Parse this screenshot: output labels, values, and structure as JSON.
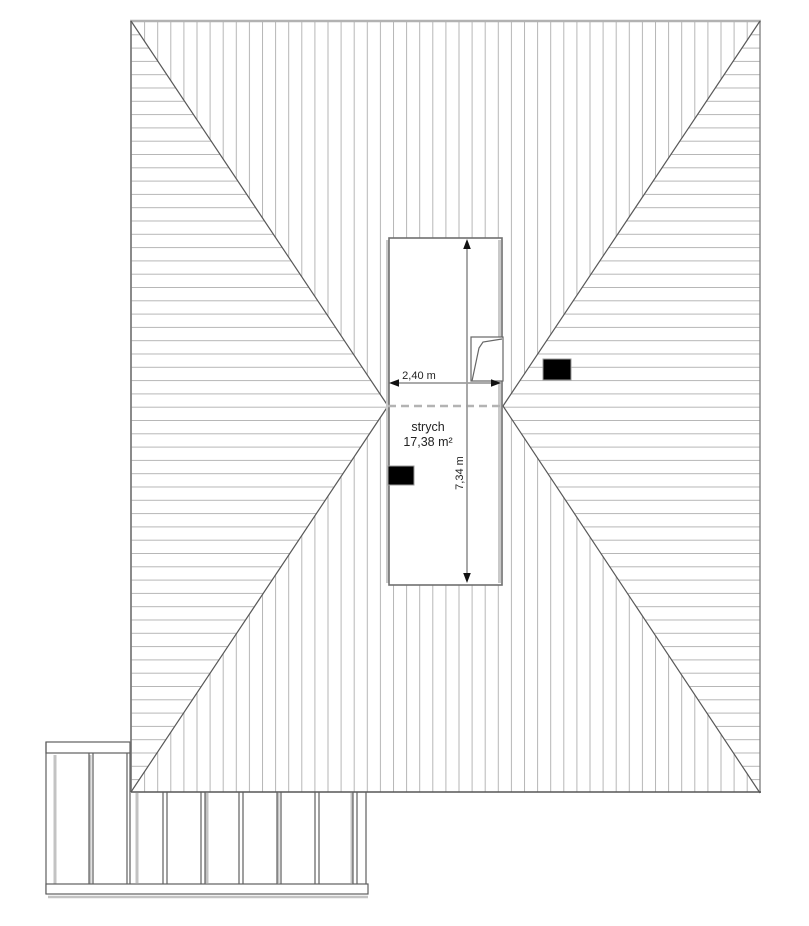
{
  "drawing": {
    "room": {
      "name": "strych",
      "area": "17,38 m²"
    },
    "dimensions": {
      "width_label": "2,40 m",
      "height_label": "7,34 m"
    }
  },
  "colors": {
    "background": "#ffffff",
    "hatch_line": "#b6b6b6",
    "roof_edge_top": "#b2b2b2",
    "roof_edge_side": "#7d7d7d",
    "roof_edge_bottom": "#565656",
    "hip_line": "#585858",
    "ridge_dash": "#b3b3b3",
    "attic_outline": "#6f6f6f",
    "attic_inner_band": "#c9c9c9",
    "roof_window_line": "#666666",
    "dimension_line": "#9e9e9e",
    "arrowhead": "#111111",
    "chimney_fill": "#000000",
    "chimney_edge": "#9a9a9a",
    "text": "#222222",
    "pergola_line": "#5f5f5f",
    "pergola_accent": "#c3c3c3"
  }
}
